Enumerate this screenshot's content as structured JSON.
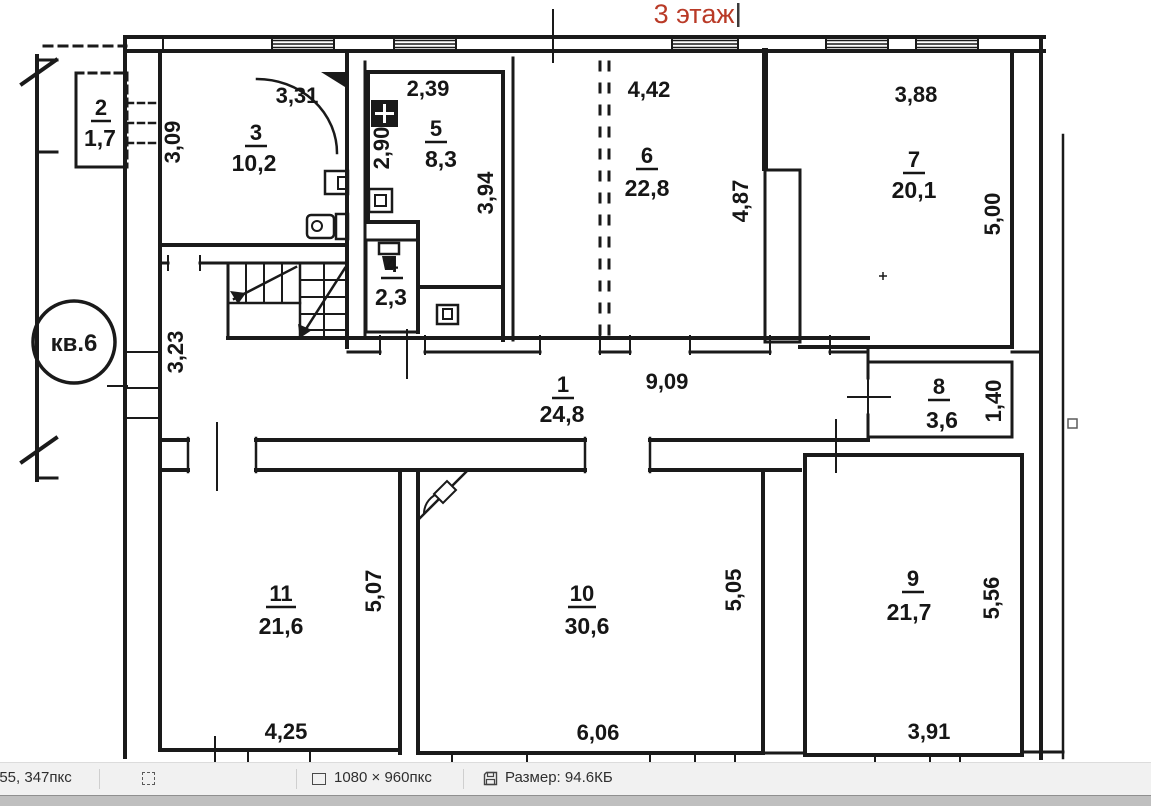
{
  "image_title": "3 этаж",
  "plan": {
    "apartment_label": "кв.6",
    "rooms": {
      "r1": {
        "num": "1",
        "area": "24,8"
      },
      "r2": {
        "num": "2",
        "area": "1,7"
      },
      "r3": {
        "num": "3",
        "area": "10,2"
      },
      "r4": {
        "num": "4",
        "area": "2,3"
      },
      "r5": {
        "num": "5",
        "area": "8,3"
      },
      "r6": {
        "num": "6",
        "area": "22,8"
      },
      "r7": {
        "num": "7",
        "area": "20,1"
      },
      "r8": {
        "num": "8",
        "area": "3,6"
      },
      "r9": {
        "num": "9",
        "area": "21,7"
      },
      "r10": {
        "num": "10",
        "area": "30,6"
      },
      "r11": {
        "num": "11",
        "area": "21,6"
      }
    },
    "dims": {
      "w309": "3,09",
      "w331": "3,31",
      "w239": "2,39",
      "w290": "2,90",
      "w394": "3,94",
      "w442": "4,42",
      "w487": "4,87",
      "w388": "3,88",
      "w500": "5,00",
      "w323": "3,23",
      "w909": "9,09",
      "w140": "1,40",
      "w507": "5,07",
      "w425": "4,25",
      "w505": "5,05",
      "w606": "6,06",
      "w556": "5,56",
      "w391": "3,91"
    }
  },
  "status_bar": {
    "cursor_position": "955, 347пкс",
    "canvas_size": "1080 × 960пкс",
    "file_size": "Размер: 94.6КБ"
  },
  "colors": {
    "title_red": "#b93a27",
    "ink": "#1a1a1a",
    "statusbar_bg": "#f1f1f1"
  }
}
